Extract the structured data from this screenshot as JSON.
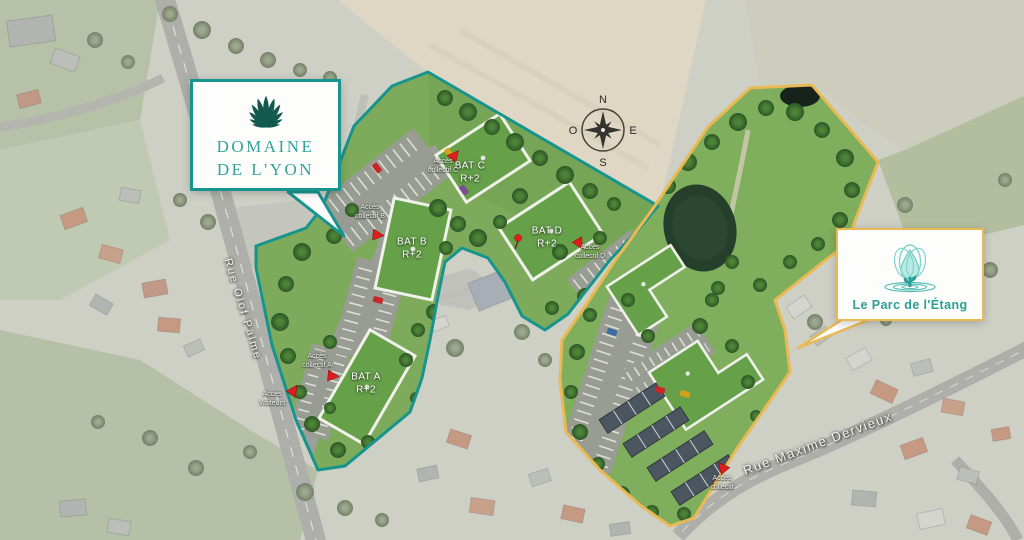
{
  "brand_cards": {
    "domaine": {
      "line1": "DOMAINE",
      "line2": "DE L'YON"
    },
    "parc": {
      "label": "Le Parc de l'Étang"
    }
  },
  "compass": {
    "north": "N",
    "east": "E",
    "south": "S",
    "west": "O"
  },
  "streets": {
    "olof_palme": "Rue Olof Palme",
    "maxime_dervieux": "Rue Maxime Dervieux"
  },
  "buildings": [
    {
      "name": "BAT C",
      "floors": "R+2"
    },
    {
      "name": "BAT D",
      "floors": "R+2"
    },
    {
      "name": "BAT B",
      "floors": "R+2"
    },
    {
      "name": "BAT A",
      "floors": "R+2"
    }
  ],
  "access_labels": [
    {
      "line1": "Accès",
      "line2": "collectif C"
    },
    {
      "line1": "Accès",
      "line2": "collectif B"
    },
    {
      "line1": "Accès",
      "line2": "collectif D"
    },
    {
      "line1": "Accès",
      "line2": "collectif A"
    },
    {
      "line1": "Accès",
      "line2": "Visiteurs"
    },
    {
      "line1": "Accès",
      "line2": "collectif"
    }
  ],
  "colors": {
    "teal_border": "#17948d",
    "teal_text": "#33a39a",
    "logo_teal_dark": "#14594e",
    "gold_border": "#e9b954",
    "marker_red": "#e31d1d"
  }
}
